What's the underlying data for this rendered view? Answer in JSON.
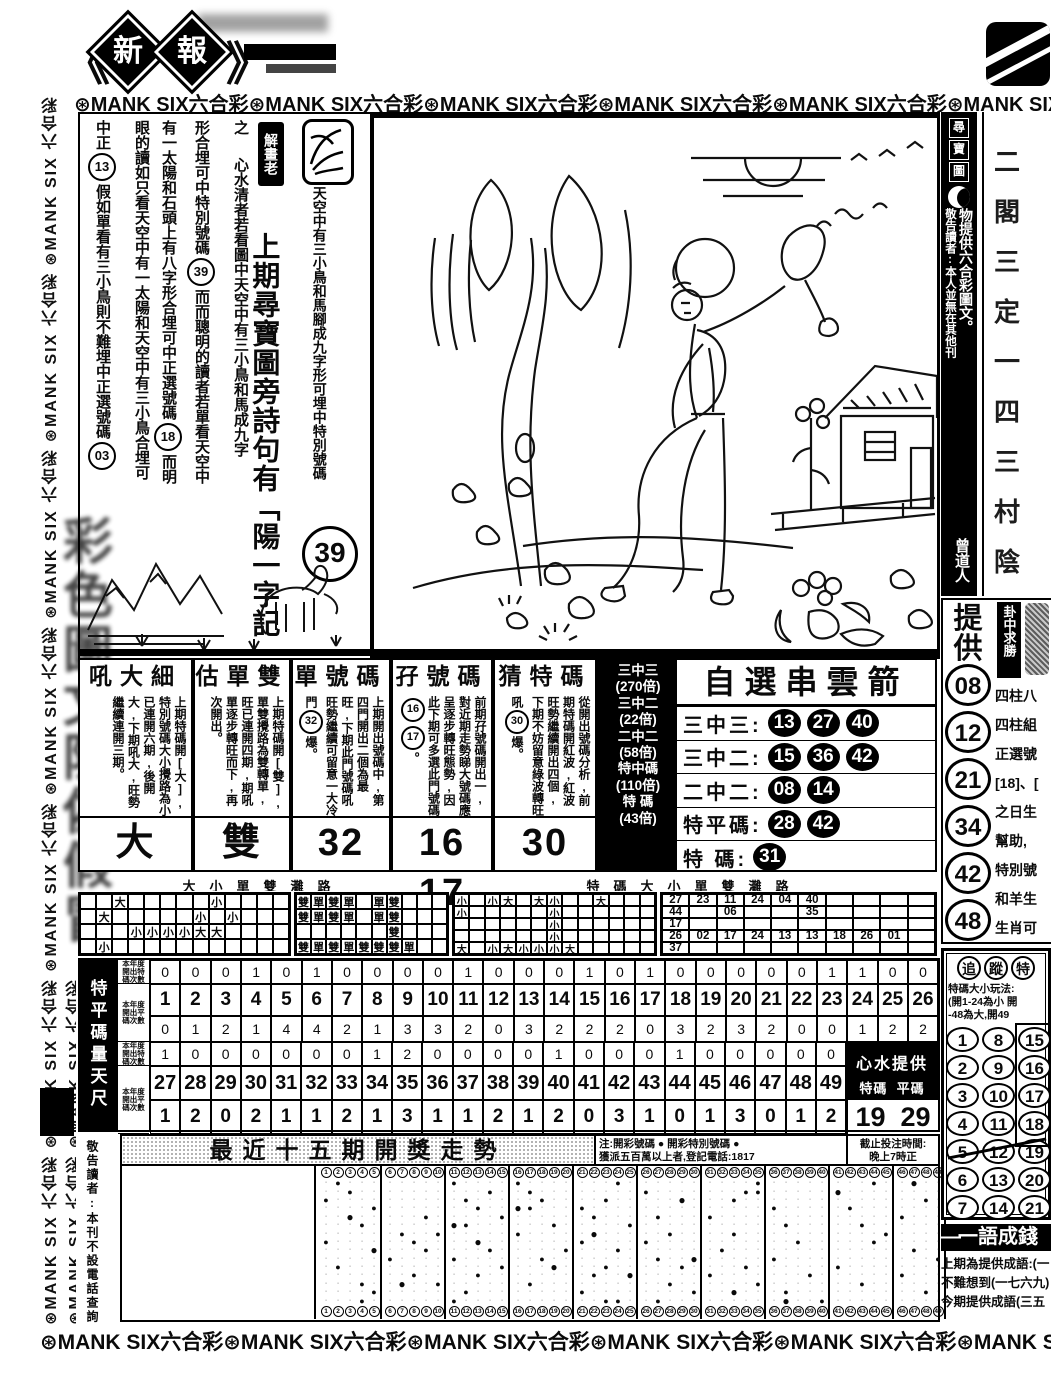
{
  "masthead": {
    "left_bracket": "《",
    "chars": [
      "新",
      "報"
    ],
    "right_bracket": "》"
  },
  "banner": {
    "segment": "⊛MANK SIX六合彩",
    "top_repeat": 6,
    "bottom_repeat": 6,
    "flower_icon": "circled-flower"
  },
  "side_banner": {
    "segment": "⊛MANK SIX 六合彩 ",
    "repeat": 9,
    "watermark_chars": "彩色圖文防偽假冒"
  },
  "article": {
    "seal_label": "解畫老",
    "seal_icon": "horse-seal",
    "caption": "天空中有三小鳥和馬腳成九字形可埋中特別號碼",
    "caption_number": "39",
    "poem": "上期尋寶圖旁詩句有「陽一字記",
    "cols": [
      [
        {
          "t": "之"
        },
        {
          "sp": 1
        },
        {
          "t": "心水清者若看圖中天空中有三小鳥和馬成九字"
        }
      ],
      [
        {
          "t": "形合埋可中特別號碼"
        },
        {
          "c": "39"
        },
        {
          "t": "而而聰明的讀者若單看天空中"
        }
      ],
      [
        {
          "t": "有一太陽和石頭上有八字形合埋可中正選號碼"
        },
        {
          "c": "18"
        },
        {
          "t": "而明"
        }
      ],
      [
        {
          "t": "眼的讀如只看天空中有一太陽和天空中有三小鳥合埋可"
        }
      ],
      [
        {
          "t": "中正"
        },
        {
          "c": "13"
        },
        {
          "t": "假如單看有三小鳥則不難埋中正選號碼"
        },
        {
          "c": "03"
        }
      ]
    ]
  },
  "right_strip": {
    "boxed": "尋寶圖",
    "line1": "物提供六合彩圖文。",
    "line2": "敬告讀者:本人並無在其他刊",
    "sign": "曾道人"
  },
  "edge_col": {
    "chars": [
      "二",
      "閣",
      "三",
      "定",
      "一",
      "四",
      "三",
      "村",
      "陰"
    ]
  },
  "tigong": {
    "label": "提供",
    "numbers": [
      "08",
      "12",
      "21",
      "34",
      "42",
      "48"
    ],
    "side_label": "卦中求勝",
    "side_lines": [
      "四柱八",
      "四柱組",
      "正選號",
      "[18]、[",
      "之日生",
      "幫助,",
      "特別號",
      "和羊生",
      "生肖可"
    ]
  },
  "panels": [
    {
      "title": "吼大細",
      "body": [
        {
          "t": "上期特碼開[大],特別號碼大小攪路為小已連開六期,後開大,下期吼大,旺勢繼續連開三期。"
        }
      ],
      "result": "大"
    },
    {
      "title": "估單雙",
      "body": [
        {
          "t": "上期特碼開[雙],單雙攪路為雙轉單,旺已連開四期,期吼單逐步轉旺而下,再次開出。"
        }
      ],
      "result": "雙"
    },
    {
      "title": "單號碼",
      "body": [
        {
          "t": "上期開出號碼中,第四門開出二個為最旺,下期此門號碼吼旺勢繼續可留意一大冷門"
        },
        {
          "c": "32"
        },
        {
          "t": "爆。"
        }
      ],
      "result": "32"
    },
    {
      "title": "孖號碼",
      "body": [
        {
          "t": "前期孖號碼開出一,對近期走勢睇大號碼應呈逐步轉旺態勢,因此下期可多選此門號碼"
        },
        {
          "c": "16"
        },
        {
          "c": "17"
        },
        {
          "t": "。"
        }
      ],
      "result": "16 17"
    },
    {
      "title": "猜特碼",
      "body": [
        {
          "t": "從開出號碼分析,前期特碼開紅波,紅波旺勢繼續開出四個,下期不妨留意綠波轉旺吼"
        },
        {
          "c": "30"
        },
        {
          "t": "爆。"
        }
      ],
      "result": "30"
    }
  ],
  "arrow": {
    "title": "自選串雲箭",
    "odds": [
      "三中三",
      "(270倍)",
      "三中二",
      "(22倍)",
      "二中二",
      "(58倍)",
      "特中碼",
      "(110倍)",
      "特 碼",
      "(43倍)"
    ],
    "rows": [
      {
        "label": "三中三",
        "nums": [
          "13",
          "27",
          "40"
        ]
      },
      {
        "label": "三中二",
        "nums": [
          "15",
          "36",
          "42"
        ]
      },
      {
        "label": "二中二",
        "nums": [
          "08",
          "14"
        ]
      },
      {
        "label": "特平碼",
        "nums": [
          "28",
          "42"
        ]
      },
      {
        "label": "特 碼",
        "nums": [
          "31"
        ]
      }
    ]
  },
  "roads": {
    "header_left": "大小單雙灘路",
    "header_right": "特碼大小單雙灘路",
    "grid_a": {
      "rows": 4,
      "cols": 13,
      "cells": [
        {
          "r": 0,
          "c": 2,
          "v": "大"
        },
        {
          "r": 0,
          "c": 8,
          "v": "小"
        },
        {
          "r": 1,
          "c": 1,
          "v": "大"
        },
        {
          "r": 1,
          "c": 7,
          "v": "小"
        },
        {
          "r": 1,
          "c": 9,
          "v": "小"
        },
        {
          "r": 2,
          "c": 3,
          "v": "小"
        },
        {
          "r": 2,
          "c": 4,
          "v": "小"
        },
        {
          "r": 2,
          "c": 5,
          "v": "小"
        },
        {
          "r": 2,
          "c": 6,
          "v": "小"
        },
        {
          "r": 2,
          "c": 7,
          "v": "大"
        },
        {
          "r": 2,
          "c": 8,
          "v": "大"
        },
        {
          "r": 3,
          "c": 1,
          "v": "小"
        }
      ]
    },
    "grid_b": {
      "rows": 4,
      "cols": 10,
      "cells": [
        {
          "r": 0,
          "c": 0,
          "v": "雙"
        },
        {
          "r": 0,
          "c": 1,
          "v": "單"
        },
        {
          "r": 0,
          "c": 2,
          "v": "雙"
        },
        {
          "r": 0,
          "c": 3,
          "v": "單"
        },
        {
          "r": 0,
          "c": 5,
          "v": "單"
        },
        {
          "r": 0,
          "c": 6,
          "v": "雙"
        },
        {
          "r": 1,
          "c": 0,
          "v": "雙"
        },
        {
          "r": 1,
          "c": 1,
          "v": "單"
        },
        {
          "r": 1,
          "c": 2,
          "v": "雙"
        },
        {
          "r": 1,
          "c": 3,
          "v": "單"
        },
        {
          "r": 1,
          "c": 5,
          "v": "單"
        },
        {
          "r": 1,
          "c": 6,
          "v": "雙"
        },
        {
          "r": 2,
          "c": 6,
          "v": "雙"
        },
        {
          "r": 3,
          "c": 0,
          "v": "雙"
        },
        {
          "r": 3,
          "c": 1,
          "v": "單"
        },
        {
          "r": 3,
          "c": 2,
          "v": "雙"
        },
        {
          "r": 3,
          "c": 3,
          "v": "單"
        },
        {
          "r": 3,
          "c": 4,
          "v": "雙"
        },
        {
          "r": 3,
          "c": 5,
          "v": "雙"
        },
        {
          "r": 3,
          "c": 6,
          "v": "雙"
        },
        {
          "r": 3,
          "c": 7,
          "v": "單"
        }
      ]
    },
    "grid_c": {
      "rows": 5,
      "cols": 13,
      "cells": [
        {
          "r": 0,
          "c": 0,
          "v": "小"
        },
        {
          "r": 0,
          "c": 2,
          "v": "小"
        },
        {
          "r": 0,
          "c": 3,
          "v": "大"
        },
        {
          "r": 0,
          "c": 5,
          "v": "大"
        },
        {
          "r": 0,
          "c": 6,
          "v": "小"
        },
        {
          "r": 0,
          "c": 9,
          "v": "大"
        },
        {
          "r": 1,
          "c": 0,
          "v": "小"
        },
        {
          "r": 1,
          "c": 6,
          "v": "小"
        },
        {
          "r": 2,
          "c": 6,
          "v": "小"
        },
        {
          "r": 3,
          "c": 6,
          "v": "小"
        },
        {
          "r": 4,
          "c": 0,
          "v": "大"
        },
        {
          "r": 4,
          "c": 2,
          "v": "小"
        },
        {
          "r": 4,
          "c": 3,
          "v": "大"
        },
        {
          "r": 4,
          "c": 4,
          "v": "小"
        },
        {
          "r": 4,
          "c": 5,
          "v": "小"
        },
        {
          "r": 4,
          "c": 6,
          "v": "小"
        },
        {
          "r": 4,
          "c": 7,
          "v": "大"
        }
      ]
    },
    "grid_d_rows": [
      [
        "27",
        "23",
        "11",
        "24",
        "04",
        "40",
        "",
        "",
        "",
        ""
      ],
      [
        "44",
        "",
        "06",
        "",
        "",
        "35",
        "",
        "",
        "",
        ""
      ],
      [
        "17",
        "",
        "",
        "",
        "",
        "",
        "",
        "",
        "",
        ""
      ],
      [
        "26",
        "02",
        "17",
        "24",
        "13",
        "13",
        "18",
        "26",
        "01",
        ""
      ],
      [
        "37",
        "",
        "",
        "",
        "",
        "",
        "",
        "",
        "",
        ""
      ]
    ]
  },
  "ruler": {
    "side_label": "特平碼量天尺",
    "row_labels": [
      "本年度開出特碼次數",
      "本年度開出平碼次數",
      "本年度開出特碼次數",
      "本年度開出平碼次數"
    ],
    "range1": [
      1,
      26
    ],
    "range2": [
      27,
      49
    ],
    "special_1_26": [
      0,
      0,
      0,
      1,
      0,
      1,
      0,
      0,
      0,
      0,
      1,
      0,
      0,
      0,
      1,
      0,
      1,
      0,
      0,
      0,
      0,
      0,
      1,
      1,
      0,
      0
    ],
    "ping_1_26": [
      0,
      1,
      2,
      1,
      4,
      4,
      2,
      1,
      3,
      3,
      2,
      0,
      3,
      2,
      2,
      2,
      0,
      3,
      2,
      3,
      2,
      0,
      0,
      1,
      2,
      2
    ],
    "special_27_49": [
      1,
      0,
      0,
      0,
      0,
      0,
      0,
      1,
      2,
      0,
      0,
      0,
      0,
      1,
      0,
      0,
      0,
      1,
      0,
      0,
      0,
      0,
      0
    ],
    "ping_27_49": [
      1,
      2,
      0,
      2,
      1,
      1,
      2,
      1,
      3,
      1,
      1,
      2,
      1,
      2,
      0,
      3,
      1,
      0,
      1,
      3,
      0,
      1,
      2
    ],
    "heart": {
      "title": "心水提供",
      "col1": "特碼",
      "col2": "平碼",
      "val1": "19",
      "val2": "29"
    }
  },
  "trend": {
    "title": "最近十五期開獎走勢",
    "note_line1": "注:開彩號碼 ● 開彩特別號碼 ●",
    "note_line2": "獲派五百萬以上者,登記電話:1817",
    "deadline_line1": "截止投注時間:",
    "deadline_line2": "晚上7時正",
    "numbers_min": 1,
    "numbers_max": 49,
    "group_size": 5,
    "draws": [
      {
        "nums": [
          2,
          11,
          16,
          24,
          35,
          44
        ],
        "special": 47
      },
      {
        "nums": [
          3,
          14,
          17,
          26,
          34,
          35
        ],
        "special": 41
      },
      {
        "nums": [
          1,
          12,
          18,
          23,
          33,
          48
        ],
        "special": 29
      },
      {
        "nums": [
          5,
          13,
          17,
          21,
          36,
          42
        ],
        "special": 16
      },
      {
        "nums": [
          9,
          15,
          22,
          27,
          31,
          46
        ],
        "special": 3
      },
      {
        "nums": [
          4,
          12,
          19,
          25,
          37,
          43
        ],
        "special": 11
      },
      {
        "nums": [
          7,
          10,
          16,
          28,
          33,
          45
        ],
        "special": 22
      },
      {
        "nums": [
          1,
          8,
          21,
          26,
          38,
          44
        ],
        "special": 13
      },
      {
        "nums": [
          9,
          14,
          20,
          24,
          32,
          47
        ],
        "special": 5
      },
      {
        "nums": [
          6,
          11,
          18,
          27,
          36,
          49
        ],
        "special": 30
      },
      {
        "nums": [
          2,
          15,
          23,
          29,
          34,
          41
        ],
        "special": 19
      },
      {
        "nums": [
          8,
          13,
          22,
          31,
          39,
          46
        ],
        "special": 25
      },
      {
        "nums": [
          4,
          10,
          17,
          28,
          35,
          43
        ],
        "special": 7
      },
      {
        "nums": [
          5,
          12,
          21,
          30,
          37,
          48
        ],
        "special": 33
      },
      {
        "nums": [
          27,
          23,
          11,
          24,
          4,
          40
        ],
        "special": 37
      }
    ]
  },
  "notice_left": {
    "lines": [
      "敬告讀者:",
      "本刊不設",
      "電話查詢"
    ]
  },
  "chase": {
    "title_chars": [
      "追",
      "蹤",
      "特"
    ],
    "rules": [
      "特碼大小玩法:",
      "(開1-24為小 開",
      "-48為大,開49"
    ],
    "grid": [
      [
        1,
        8,
        15
      ],
      [
        2,
        9,
        16
      ],
      [
        3,
        10,
        17
      ],
      [
        4,
        11,
        18
      ],
      [
        5,
        12,
        19
      ],
      [
        6,
        13,
        20
      ],
      [
        7,
        14,
        21
      ]
    ]
  },
  "idiom": {
    "banner": "一語成錢",
    "lines": [
      "上期為提供成語:(一",
      "不難想到(一七六九)",
      "今期提供成語(三五"
    ]
  }
}
